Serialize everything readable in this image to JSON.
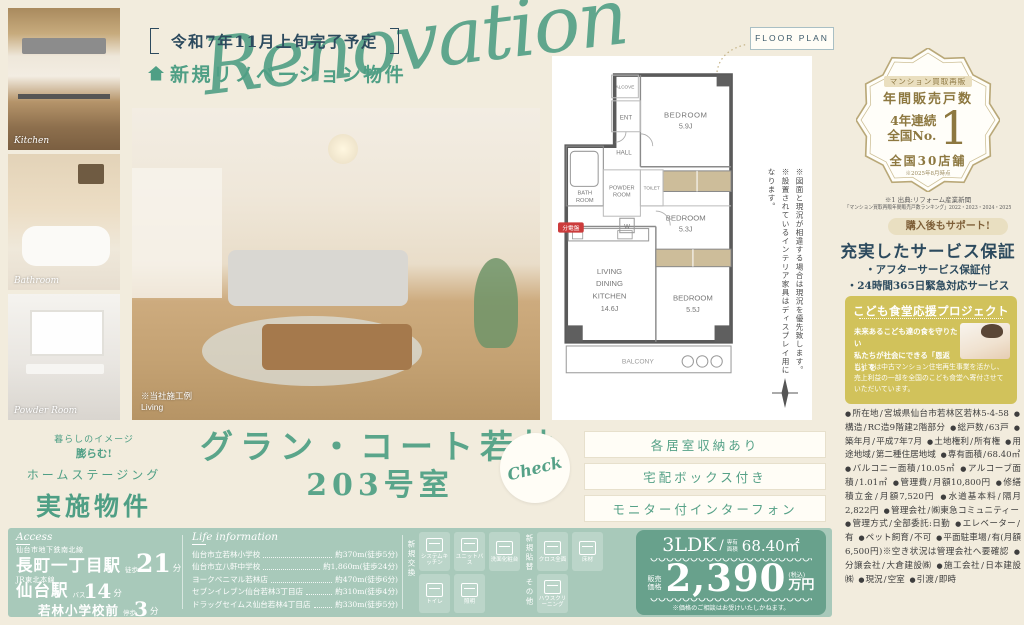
{
  "header": {
    "completion": "令和7年11月上旬完了予定",
    "property_type": "新規リノベーション物件",
    "script": "Renovation"
  },
  "photos": {
    "kitchen_label": "Kitchen",
    "bathroom_label": "Bathroom",
    "powder_label": "Powder Room",
    "living_note": "※当社施工例",
    "living_label": "Living"
  },
  "floor_plan": {
    "tag": "FLOOR PLAN",
    "rooms": {
      "bedroom_word": "BEDROOM",
      "bed1_size": "5.9J",
      "bed2_size": "5.3J",
      "bed3_size": "5.5J",
      "ldk_line1": "LIVING",
      "ldk_line2": "DINING",
      "ldk_line3": "KITCHEN",
      "ldk_size": "14.6J",
      "bath_line1": "BATH",
      "bath_line2": "ROOM",
      "powder_line1": "POWDER",
      "powder_line2": "ROOM",
      "toilet": "TOILET",
      "hall": "HALL",
      "ent": "ENT",
      "alcove": "ALCOVE",
      "balcony": "BALCONY",
      "washer": "W",
      "breaker": "分電盤"
    },
    "note1": "※図面と現況が相違する場合は現況を優先致します。",
    "note2": "※設置されているインテリア家具はディスプレイ用になります。"
  },
  "award": {
    "top": "マンション買取再販",
    "sub": "年間販売戸数",
    "main1": "4年連続",
    "main2": "全国No.",
    "number": "1",
    "stores": "全国30店舗",
    "asof": "※2025年8月時点",
    "source1": "※1 出典:リフォーム産業新聞",
    "source2": "「マンション買取再販年間販売戸数ランキング」2022・2023・2024・2025"
  },
  "support": {
    "badge": "購入後もサポート!",
    "title": "充実したサービス保証",
    "items": [
      "・アフターサービス保証付",
      "・24時間365日緊急対応サービス"
    ]
  },
  "kodomo": {
    "title": "こども食堂応援プロジェクト",
    "lead1": "未来あるこども達の食を守りたい",
    "lead2": "私たちが社会にできる「恩返し」を",
    "body": "当社では中古マンション住宅再生事業を活かし、売上利益の一部を全国のこども食堂へ寄付させていただいています。"
  },
  "details": [
    {
      "label": "所在地",
      "value": "宮城県仙台市若林区若林5-4-58"
    },
    {
      "label": "構造",
      "value": "RC造9階建2階部分"
    },
    {
      "label": "総戸数",
      "value": "63戸"
    },
    {
      "label": "築年月",
      "value": "平成7年7月"
    },
    {
      "label": "土地権利",
      "value": "所有権"
    },
    {
      "label": "用途地域",
      "value": "第二種住居地域"
    },
    {
      "label": "専有面積",
      "value": "68.40㎡"
    },
    {
      "label": "バルコニー面積",
      "value": "10.05㎡"
    },
    {
      "label": "アルコーブ面積",
      "value": "1.01㎡"
    },
    {
      "label": "管理費",
      "value": "月額10,800円"
    },
    {
      "label": "修繕積立金",
      "value": "月額7,520円"
    },
    {
      "label": "水道基本料",
      "value": "隔月2,822円"
    },
    {
      "label": "管理会社",
      "value": "㈱東急コミュニティー"
    },
    {
      "label": "管理方式",
      "value": "全部委託:日勤"
    },
    {
      "label": "エレベーター",
      "value": "有"
    },
    {
      "label": "ペット飼育",
      "value": "不可"
    },
    {
      "label": "平面駐車場",
      "value": "有(月額6,500円)※空き状況は管理会社へ要確認"
    },
    {
      "label": "分譲会社",
      "value": "大倉建設㈱"
    },
    {
      "label": "施工会社",
      "value": "日本建設㈱"
    },
    {
      "label": "現況",
      "value": "空室"
    },
    {
      "label": "引渡",
      "value": "即時"
    }
  ],
  "staging": {
    "arc1": "暮らしのイメージ",
    "arc2": "膨らむ!",
    "line1": "ホームステージング",
    "line2": "実施物件"
  },
  "name": {
    "line1": "グラン・コート若林",
    "line2": "203号室",
    "check": "Check"
  },
  "features": [
    {
      "label": "各居室収納あり"
    },
    {
      "label": "宅配ボックス付き"
    },
    {
      "label": "モニター付インターフォン"
    }
  ],
  "access": {
    "heading": "Access",
    "r1_line": "仙台市地下鉄南北線",
    "r1_station": "長町一丁目駅",
    "r1_mode": "徒歩",
    "r1_min": "21",
    "r1_unit": "分",
    "r2_line": "JR東北本線",
    "r2_station": "仙台駅",
    "r2_mode": "バス",
    "r2_min": "14",
    "r2_unit": "分",
    "r3_station": "若林小学校前",
    "r3_mode": "停歩",
    "r3_min": "3",
    "r3_unit": "分"
  },
  "life": {
    "heading": "Life information",
    "rows": [
      {
        "name": "仙台市立若林小学校",
        "dist": "約370m(徒歩5分)"
      },
      {
        "name": "仙台市立八軒中学校",
        "dist": "約1,860m(徒歩24分)"
      },
      {
        "name": "ヨークベニマル若林店",
        "dist": "約470m(徒歩6分)"
      },
      {
        "name": "セブンイレブン仙台若林3丁目店",
        "dist": "約310m(徒歩4分)"
      },
      {
        "name": "ドラッグセイムス仙台若林4丁目店",
        "dist": "約330m(徒歩5分)"
      }
    ]
  },
  "equipment": {
    "group1_label": "新規交換",
    "group1_row1": [
      {
        "label": "システムキッチン",
        "icon": "system-kitchen-icon"
      },
      {
        "label": "ユニットバス",
        "icon": "unit-bath-icon"
      },
      {
        "label": "洗面化粧台",
        "icon": "vanity-icon"
      }
    ],
    "group1_row2": [
      {
        "label": "トイレ",
        "icon": "toilet-icon"
      },
      {
        "label": "照明",
        "icon": "light-icon"
      }
    ],
    "group2_label": "新規貼替",
    "group2_row": [
      {
        "label": "クロス全面",
        "icon": "wallpaper-icon"
      },
      {
        "label": "床材",
        "icon": "flooring-icon"
      }
    ],
    "group3_label": "その他",
    "group3_row": [
      {
        "label": "ハウスクリーニング",
        "icon": "house-cleaning-icon"
      }
    ]
  },
  "price": {
    "layout": "3LDK",
    "area_label": "専有面積",
    "area": "68.40㎡",
    "price_label": "販売価格",
    "amount": "2,390",
    "tax": "(税込)",
    "unit": "万円",
    "note": "※価格のご相談はお受けいたしかねます。"
  },
  "colors": {
    "accent_green": "#4f9f85",
    "band_green": "#a8c9ba",
    "price_green": "#68a18c",
    "gold": "#a48e58",
    "navy": "#2c4a5e",
    "yellow_box": "#d1c25b",
    "background": "#f2ecdd"
  }
}
